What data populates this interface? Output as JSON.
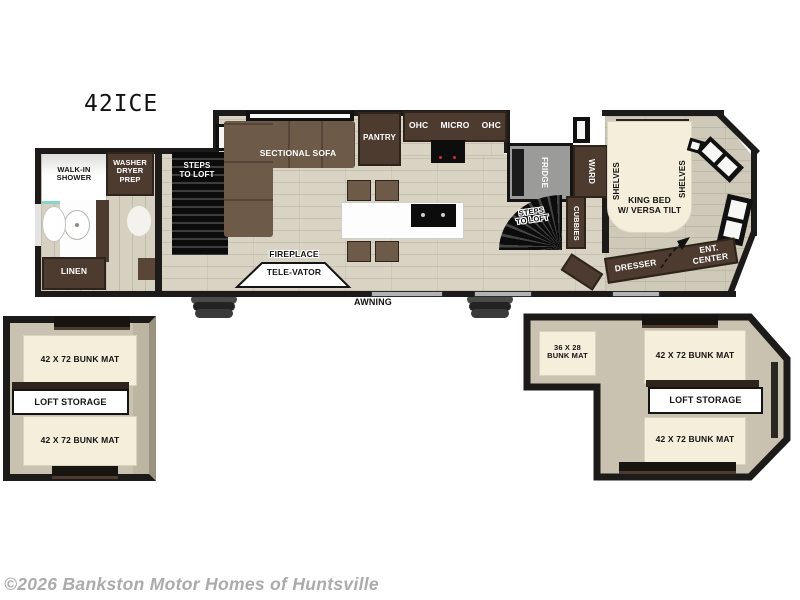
{
  "title": "42ICE",
  "copyright": "©2026 Bankston Motor Homes of Huntsville",
  "colors": {
    "wall": "#1d1b19",
    "floor": "#d9d3c3",
    "floor_bath": "#d6d0c0",
    "floor_bed": "#cfc9b9",
    "cabinet": "#4c3b2e",
    "cabinet_dark": "#2e241c",
    "sofa": "#6e5a49",
    "cream": "#f4eedb",
    "fridge_gray": "#9b9b99",
    "loft_wall": "#c9c2b0",
    "shower_glass": "#86d7cb",
    "copyright_gray": "#ababab"
  },
  "labels": {
    "walk_in_shower": "WALK-IN\nSHOWER",
    "washer_dryer_prep": "WASHER\nDRYER\nPREP",
    "linen": "LINEN",
    "steps_to_loft_rear": "STEPS\nTO LOFT",
    "sectional_sofa": "SECTIONAL SOFA",
    "pantry": "PANTRY",
    "ohc_left": "OHC",
    "micro": "MICRO",
    "ohc_right": "OHC",
    "fridge": "FRIDGE",
    "ward": "WARD",
    "steps_to_loft_front": "STEPS\nTO LOFT",
    "cubbies": "CUBBIES",
    "shelves_left": "SHELVES",
    "shelves_right": "SHELVES",
    "king_bed": "KING BED\nW/ VERSA TILT",
    "fireplace": "FIREPLACE",
    "tele_vator": "TELE-VATOR",
    "awning": "AWNING",
    "dresser": "DRESSER",
    "ent_center": "ENT.\nCENTER"
  },
  "loft_left": {
    "bunk_top": "42 X 72 BUNK MAT",
    "storage": "LOFT STORAGE",
    "bunk_bottom": "42 X 72 BUNK MAT"
  },
  "loft_right": {
    "bunk_small": "36 X 28\nBUNK MAT",
    "bunk_top": "42 X 72 BUNK MAT",
    "storage": "LOFT STORAGE",
    "bunk_bottom": "42 X 72 BUNK MAT"
  }
}
